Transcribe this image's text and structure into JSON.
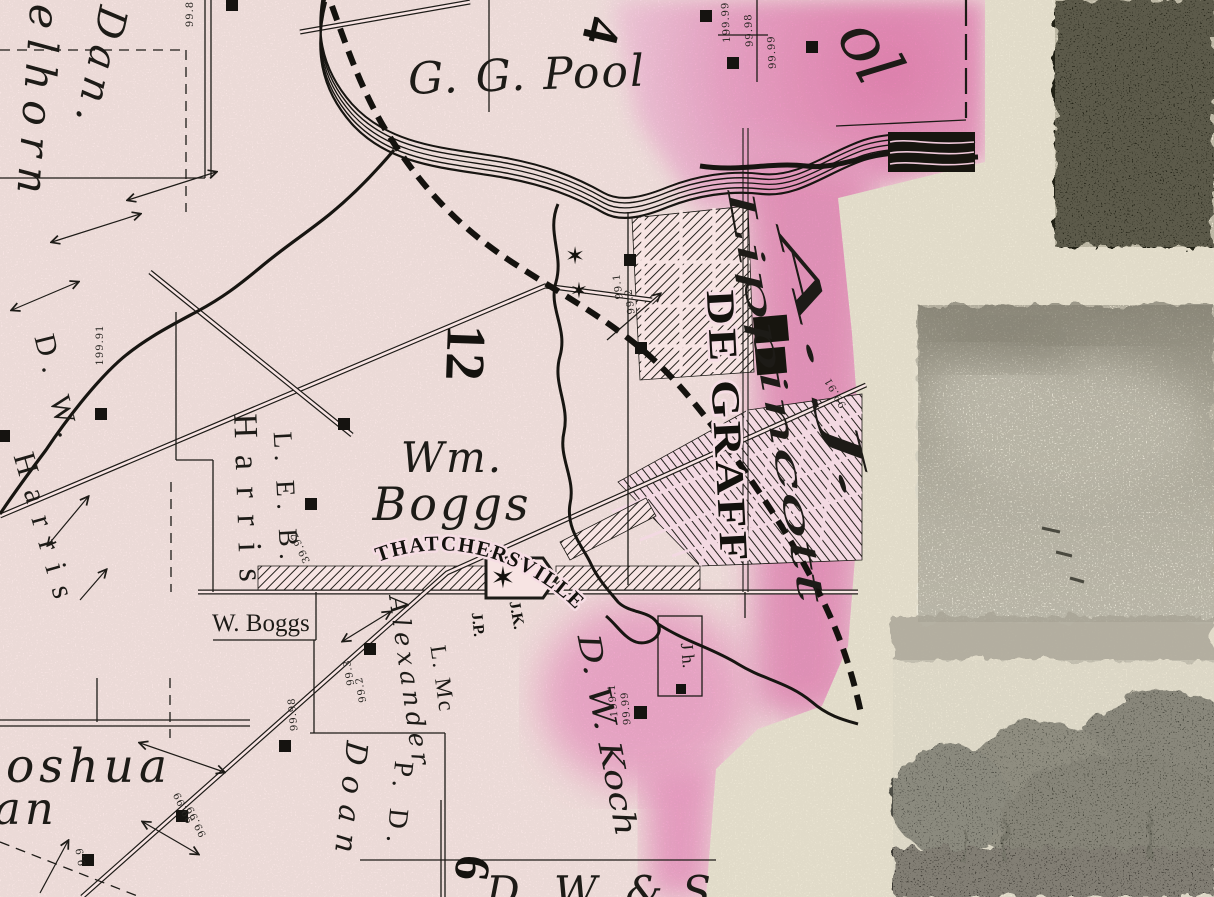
{
  "labels": {
    "section_4": "4",
    "section_12": "12",
    "section_6": "6",
    "dan": "Dan.",
    "elhorn": "elhorn",
    "gg_pool": "G. G. Pool",
    "pool_partial": "ol",
    "a_j": "A. J.",
    "lippincott": "Lippincott",
    "de_graff": "DE GRAFF",
    "wm": "Wm.",
    "boggs": "Boggs",
    "leb": "L. E. B.",
    "harris_east": "Harris",
    "dw": "D. W.",
    "harris_west": "Harris",
    "w_boggs": "W. Boggs",
    "thatchersville": "THATCHERSVILLE",
    "jk": "J.K.",
    "jp": "J.P.",
    "jh": "J h.",
    "l_mc": "L. Mc",
    "alexander": "Alexander",
    "dw_koch": "D. W. Koch",
    "pd": "P. D.",
    "doan": "Doan",
    "joshua_partial": "oshua",
    "an_partial": "an",
    "dw_and_s": "D. W. & S"
  },
  "acreage": {
    "tr_a": "199.99",
    "tr_b": "99.98",
    "tr_c": "99.99",
    "top_edge": "99.8",
    "left_edge": "199.91",
    "lippincott_tract": "99.91",
    "degraff_west_a": "99.1",
    "degraff_west_b": "99.2",
    "harris_tract": "39.92",
    "alexander_a": "99.3",
    "alexander_b": "99.2",
    "road_west": "99.98",
    "koch_a": "199.1",
    "koch_b": "99.99",
    "bottom_a": "99.99",
    "bottom_b": "99.99",
    "bottom_small": "9.9"
  },
  "symbols": {
    "star": "✶"
  },
  "colors": {
    "map_paper": "#f7e4e3",
    "pink_tint": "#e78fbc",
    "cream_paper": "#ece6d4",
    "ink": "#1d1b17"
  }
}
